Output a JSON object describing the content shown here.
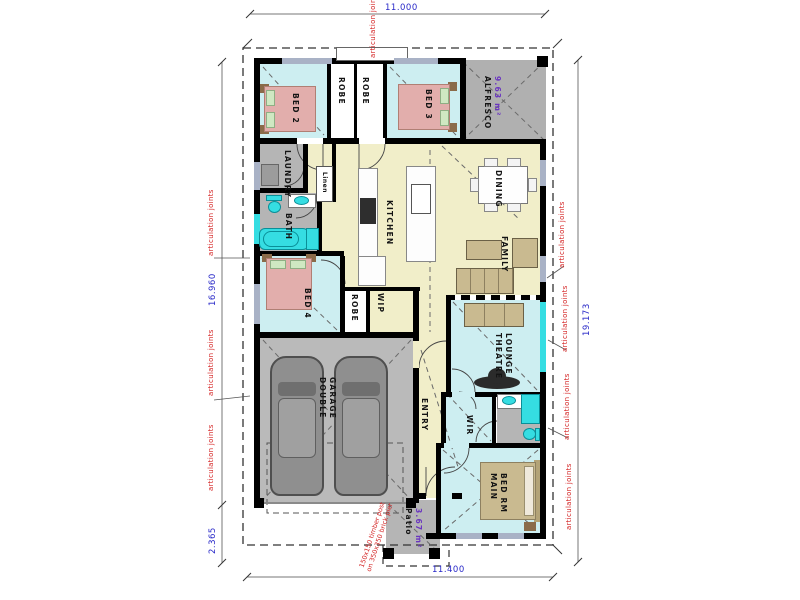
{
  "plan": {
    "type": "residential floor plan"
  },
  "rooms": {
    "bed2": "BED 2",
    "robe_a": "ROBE",
    "robe_b": "ROBE",
    "bed3": "BED 3",
    "alfresco": "ALFRESCO",
    "alfresco_area": "9.63 m²",
    "laundry": "LAUNDRY",
    "linen": "Linen",
    "bath": "BATH",
    "kitchen": "KITCHEN",
    "dining": "DINING",
    "family": "FAMILY",
    "bed4": "BED 4",
    "robe_c": "ROBE",
    "wip": "WIP",
    "theatre_1": "THEATRE",
    "theatre_2": "LOUNGE",
    "garage_1": "DOUBLE",
    "garage_2": "GARAGE",
    "entry": "ENTRY",
    "wir": "WIR",
    "main_1": "MAIN",
    "main_2": "BED RM",
    "patio": "Patio",
    "patio_area": "3.67 m²"
  },
  "dimensions": {
    "top": "11.000",
    "bottom": "11.400",
    "left_upper": "16.960",
    "left_lower": "2.365",
    "right": "19.173"
  },
  "annotations": {
    "articulation": "articulation joints",
    "post_note_1": "150x150 timber post",
    "post_note_2": "on 350x350 brick pier"
  },
  "colors": {
    "bedroom_fill": "#cdeef1",
    "living_fill": "#f1eec9",
    "wet_area_fill": "#b5b5b5",
    "garage_fill": "#bababa",
    "fixture_cyan": "#35dde2",
    "furniture_tan": "#c9ba90",
    "bed_pink": "#e2aeac",
    "wall": "#000000",
    "dimension_text": "#2828c8",
    "annotation_text": "#d42222",
    "area_text": "#6a35c0"
  }
}
